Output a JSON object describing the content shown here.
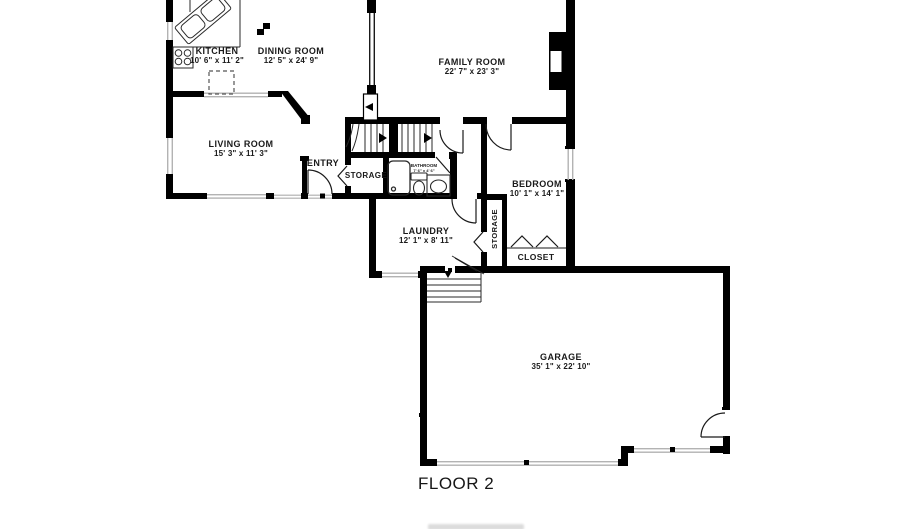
{
  "floor_label": "FLOOR 2",
  "rooms": {
    "kitchen": {
      "name": "KITCHEN",
      "dims": "10' 6\" x 11' 2\""
    },
    "dining": {
      "name": "DINING ROOM",
      "dims": "12' 5\" x 24' 9\""
    },
    "family": {
      "name": "FAMILY ROOM",
      "dims": "22' 7\" x 23' 3\""
    },
    "living": {
      "name": "LIVING ROOM",
      "dims": "15' 3\" x 11' 3\""
    },
    "entry": {
      "name": "ENTRY"
    },
    "storage_hall": {
      "name": "STORAGE"
    },
    "bathroom": {
      "name": "BATHROOM",
      "dims": "7' 6\" x 4' 6\""
    },
    "bedroom": {
      "name": "BEDROOM",
      "dims": "10' 1\" x 14' 1\""
    },
    "laundry": {
      "name": "LAUNDRY",
      "dims": "12' 1\" x 8' 11\""
    },
    "storage_closet": {
      "name": "STORAGE"
    },
    "closet": {
      "name": "CLOSET"
    },
    "garage": {
      "name": "GARAGE",
      "dims": "35' 1\" x 22' 10\""
    }
  },
  "colors": {
    "background": "#ffffff",
    "wall": "#000000",
    "window_line": "#b3b3b3",
    "thin_line": "#2a2a2a",
    "label_text": "#1a1a1a"
  }
}
